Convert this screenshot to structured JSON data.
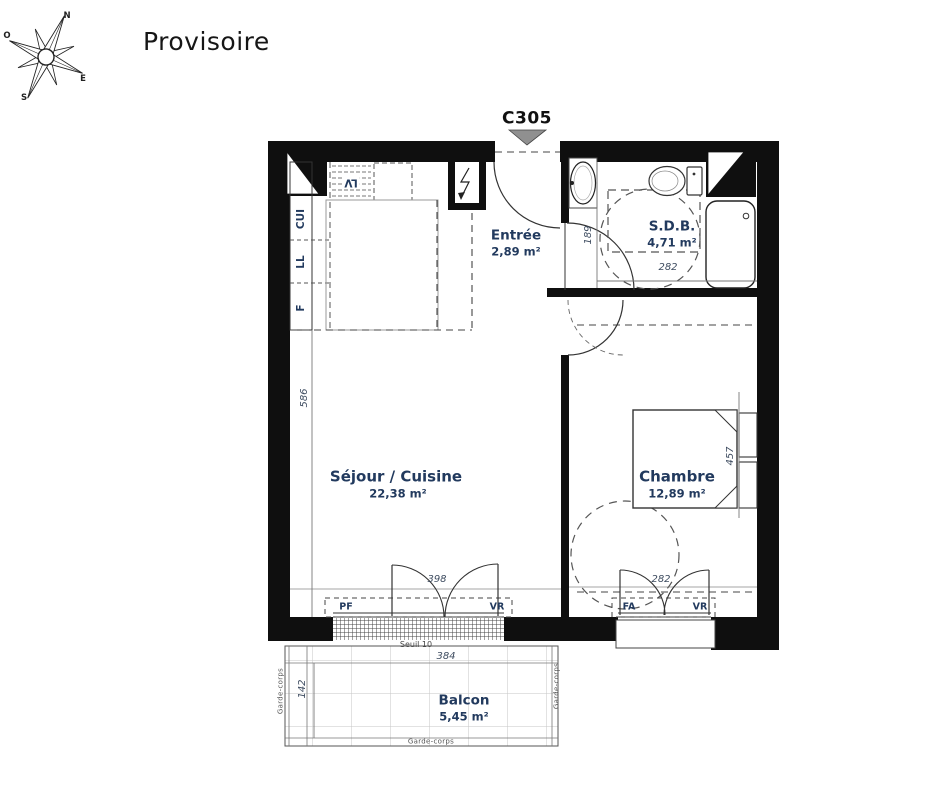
{
  "header": {
    "title": "Provisoire"
  },
  "unit_label": "C305",
  "compass": {
    "n": "N",
    "o": "O",
    "e": "E",
    "s": "S"
  },
  "rooms": {
    "entree": {
      "name": "Entrée",
      "area": "2,89 m²"
    },
    "sdb": {
      "name": "S.D.B.",
      "area": "4,71 m²"
    },
    "sejour": {
      "name": "Séjour / Cuisine",
      "area": "22,38 m²"
    },
    "chambre": {
      "name": "Chambre",
      "area": "12,89 m²"
    },
    "balcon": {
      "name": "Balcon",
      "area": "5,45 m²"
    }
  },
  "fixtures": {
    "cui": "CUI",
    "ll": "LL",
    "f": "F",
    "lv": "LV",
    "pf": "PF",
    "vr_sejour": "VR",
    "fa": "FA",
    "vr_chambre": "VR"
  },
  "annotations": {
    "seuil": "Seuil 10",
    "garde_left": "Garde-corps",
    "garde_bottom": "Garde-corps",
    "garde_right": "Garde-corps"
  },
  "dims": {
    "sejour_height": "586",
    "entree_height": "189",
    "sdb_width": "282",
    "chambre_height": "457",
    "sejour_window": "398",
    "chambre_window": "282",
    "balcon_width": "384",
    "balcon_depth": "142"
  },
  "colors": {
    "wall": "#0f0f0f",
    "label": "#223a5e",
    "dim": "#3e4c60",
    "triangle": "#909090"
  }
}
